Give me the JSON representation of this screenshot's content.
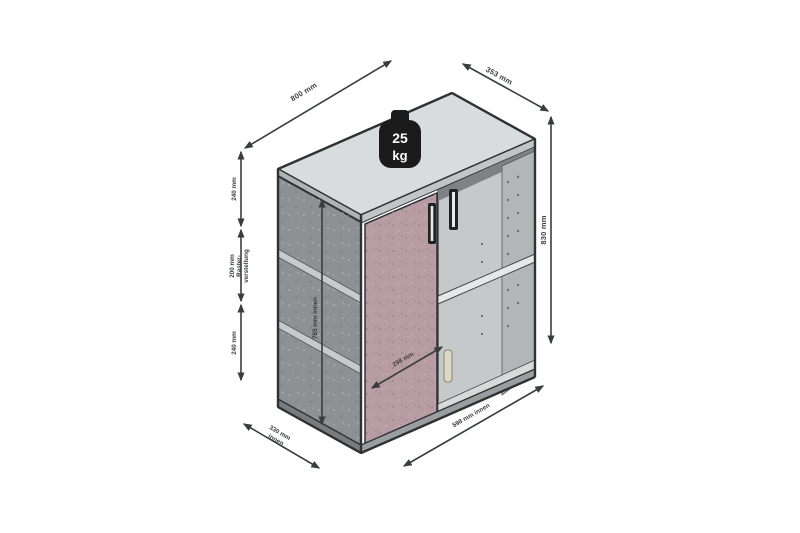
{
  "diagram": {
    "description": "isometric-cabinet-dimension-diagram",
    "weight_badge": {
      "value": "25",
      "unit": "kg"
    },
    "labels": {
      "width": "800 mm",
      "depth": "353 mm",
      "height": "830 mm",
      "shelf_top": "240 mm",
      "shelf_mid_line1": "200 mm",
      "shelf_mid_line2": "Raster-",
      "shelf_mid_line3": "verstellung",
      "shelf_bottom": "240 mm",
      "inner_height": "785 mm innen",
      "door_width": "298 mm",
      "inner_depth_line1": "330 mm",
      "inner_depth_line2": "innen",
      "inner_width": "598 mm innen"
    },
    "colors": {
      "background": "#ffffff",
      "top_face": "#d9dcdd",
      "top_edge_front": "#c2c5c6",
      "top_edge_left": "#b0b3b4",
      "side_face": "#8d9193",
      "shelf_band": "#c6cacb",
      "door": "#b79ca4",
      "interior_back": "#c5c9ca",
      "interior_right": "#b2b6b7",
      "interior_shadow": "#7e8284",
      "shelf_surface": "#e6e8e8",
      "bottom_panel": "#d8dada",
      "plinth_front": "#9a9ea0",
      "plinth_side": "#787c7e",
      "annotation": "#3a3d3f",
      "badge": "#1b1b1b",
      "handle_dark": "#1f2325",
      "handle_light": "#ddd8c6"
    }
  }
}
